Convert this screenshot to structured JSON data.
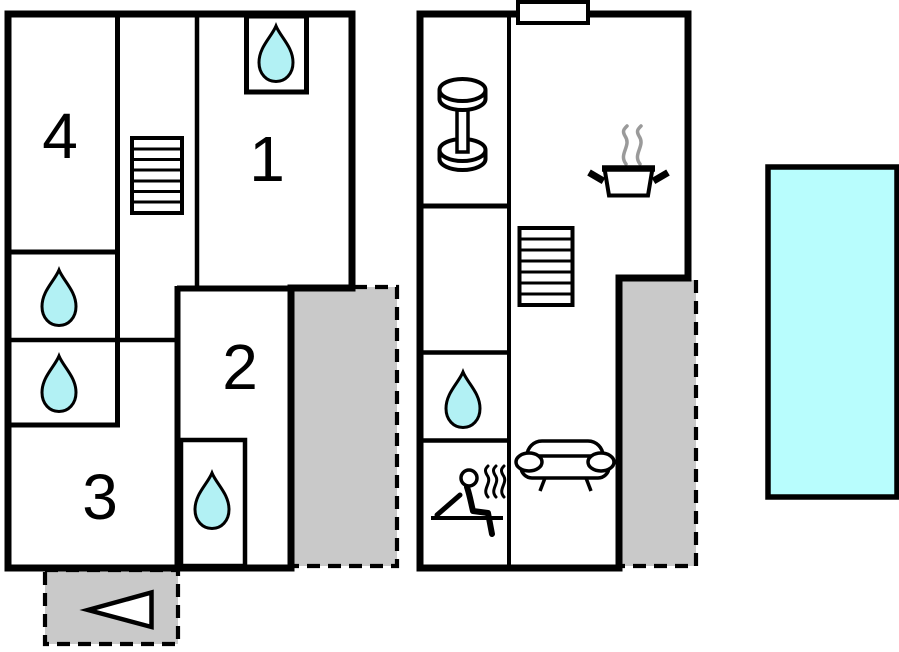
{
  "plan": {
    "type": "vacation-home-floorplan",
    "left_building": {
      "rooms": [
        {
          "id": "room-1",
          "label": "1"
        },
        {
          "id": "room-2",
          "label": "2"
        },
        {
          "id": "room-3",
          "label": "3"
        },
        {
          "id": "room-4",
          "label": "4"
        }
      ],
      "water_points": 4,
      "has_stairs": true,
      "has_terrace": true,
      "entrance_arrow_direction": "left"
    },
    "right_building": {
      "features": [
        "fitness-dumbbell",
        "stairs",
        "kitchen-pot",
        "water-point",
        "sauna",
        "sofa-lounge"
      ],
      "has_terrace": true,
      "has_chimney_vent": true
    },
    "outdoor": {
      "pool": true,
      "terrace_count": 3
    },
    "colors": {
      "wall": "#000000",
      "water": "#b2f1f4",
      "pool": "#b8fdfd",
      "terrace": "#c9c9c9",
      "steam": "#9a9a9a"
    }
  }
}
